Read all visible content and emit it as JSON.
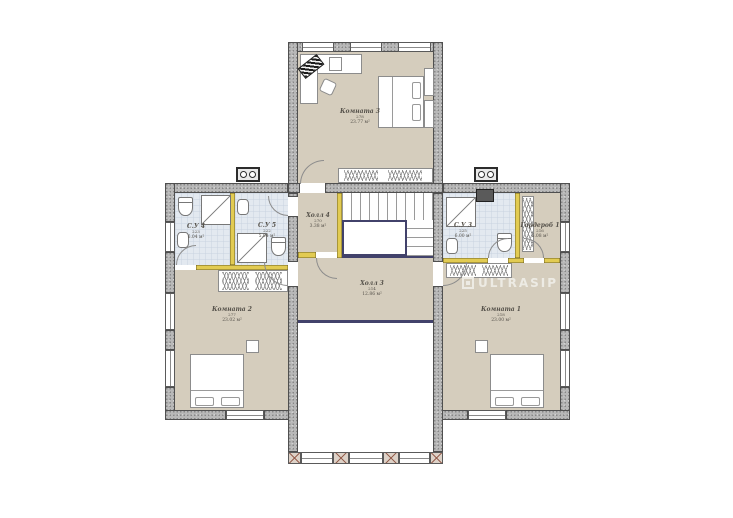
{
  "watermark": {
    "text": "ULTRASIP",
    "logo": "square-logo"
  },
  "rooms": {
    "room3": {
      "name": "Комната 3",
      "code": "278",
      "area": "23.77 м²"
    },
    "room2": {
      "name": "Комната 2",
      "code": "277",
      "area": "23.02 м²"
    },
    "room1": {
      "name": "Комната 1",
      "code": "218",
      "area": "23.00 м²"
    },
    "hall4": {
      "name": "Холл 4",
      "code": "270",
      "area": "3.38 м²"
    },
    "hall3": {
      "name": "Холл 3",
      "code": "214",
      "area": "12.86 м²"
    },
    "su4": {
      "name": "С.У 4",
      "code": "223",
      "area": "6.04 м²"
    },
    "su5": {
      "name": "С.У 5",
      "code": "222",
      "area": "5.04 м²"
    },
    "su3": {
      "name": "С.У 3",
      "code": "225",
      "area": "6.00 м²"
    },
    "wardrobe1": {
      "name": "Гардероб 1",
      "code": "216",
      "area": "5.08 м²"
    }
  },
  "colors": {
    "wall": "#b8b8b8",
    "wall_edge": "#4f4f4f",
    "floor": "#d5cdbd",
    "bathroom_tile": "#e3e9f0",
    "partition": "#e2cb52",
    "railing": "#42426b",
    "window_pier": "#96604f",
    "label_text": "#55514a",
    "watermark": "#edebe4"
  }
}
